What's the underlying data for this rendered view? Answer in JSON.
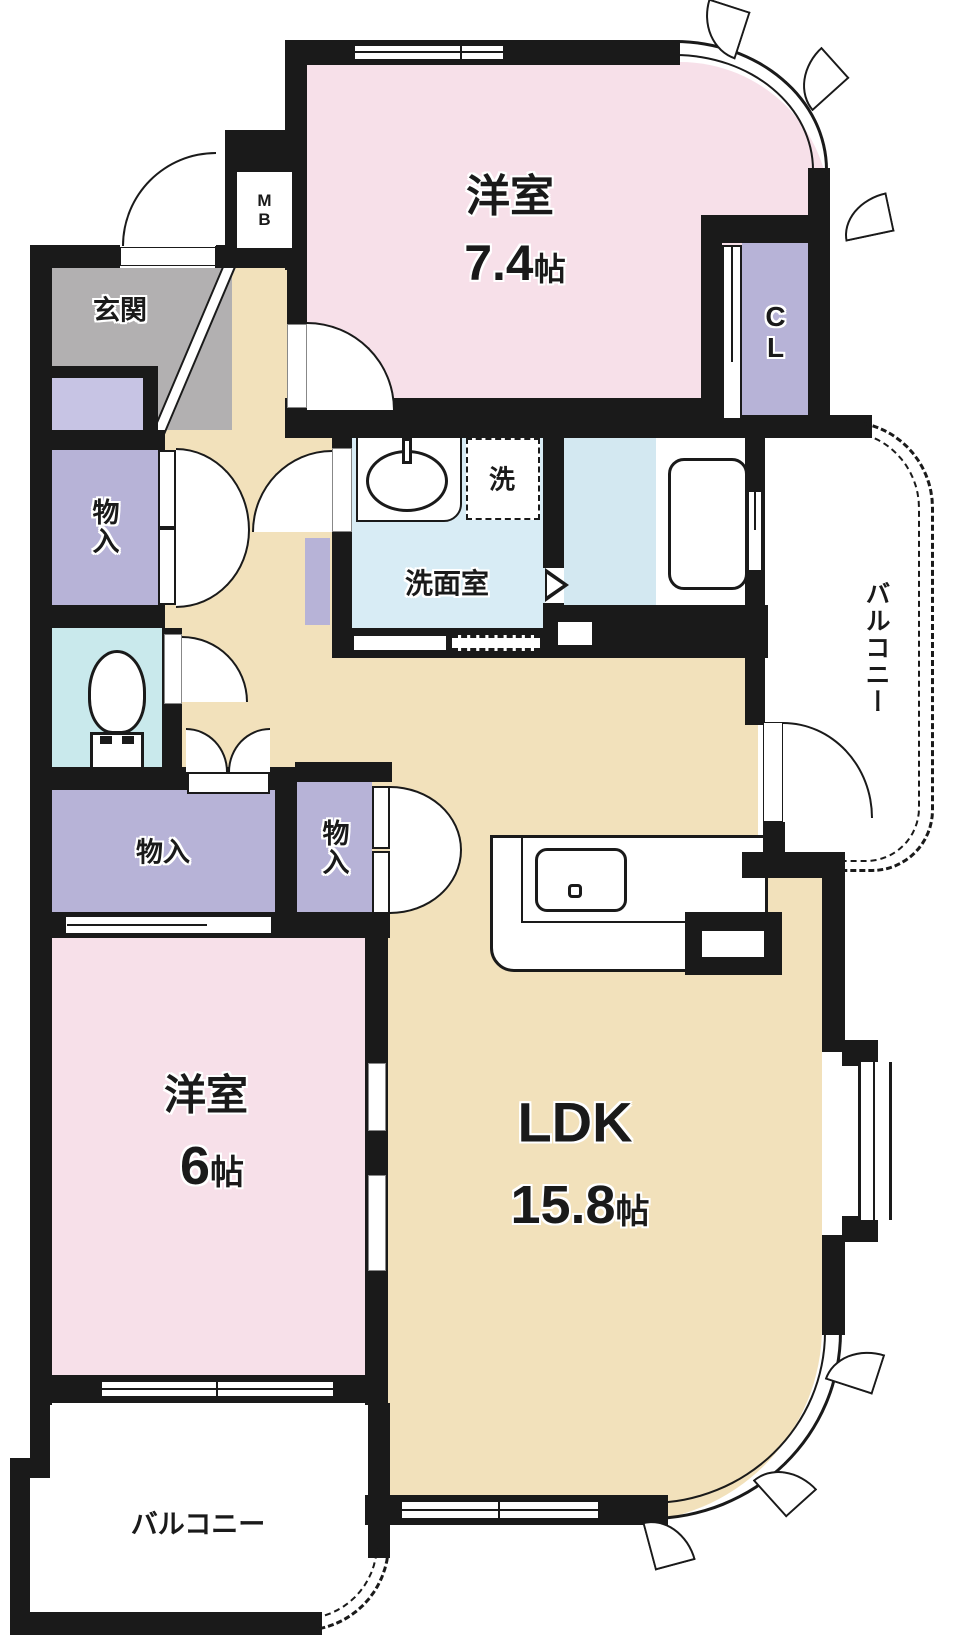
{
  "rooms": {
    "western1": {
      "label": "洋室",
      "size": "7.4",
      "unit": "帖"
    },
    "western2": {
      "label": "洋室",
      "size": "6",
      "unit": "帖"
    },
    "ldk": {
      "label": "LDK",
      "size": "15.8",
      "unit": "帖"
    },
    "entrance": {
      "label": "玄関"
    },
    "washroom": {
      "label": "洗面室"
    },
    "washer": {
      "label": "洗"
    },
    "closet": {
      "label": "CL"
    },
    "meter_box": {
      "label": "MB"
    },
    "storage_upper": {
      "label": "物入"
    },
    "storage_wide": {
      "label": "物入"
    },
    "storage_small": {
      "label": "物入"
    },
    "balcony_right": {
      "label": "バルコニー"
    },
    "balcony_bottom": {
      "label": "バルコニー"
    }
  },
  "colors": {
    "wall": "#1a1a1a",
    "bedroom": "#f7e0e9",
    "ldk": "#f2e1bb",
    "storage": "#b7b3d7",
    "shoebox": "#c7c4e4",
    "entrance": "#b2b0b1",
    "washroom": "#d8ecf5",
    "bath_blue": "#d3e8f1",
    "bath_white": "#ffffff",
    "toilet": "#c9e9ec",
    "balcony": "#ffffff"
  }
}
